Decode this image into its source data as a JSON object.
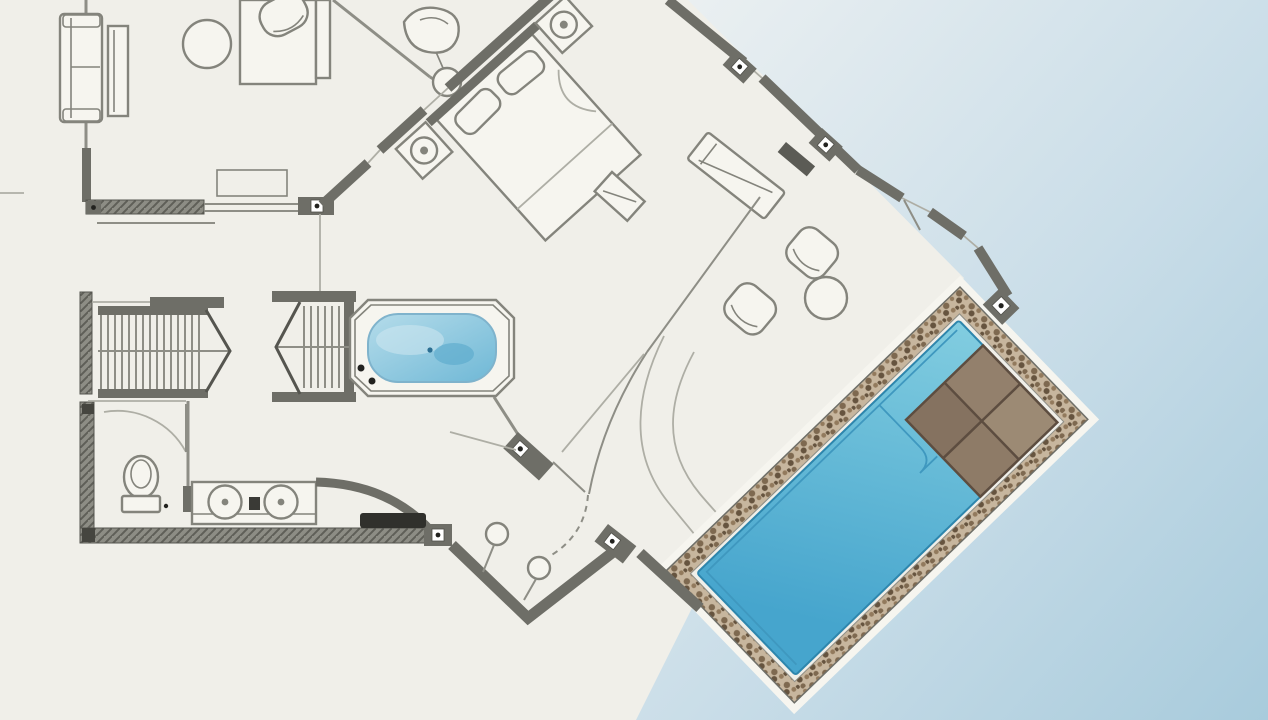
{
  "canvas": {
    "width": 1268,
    "height": 720,
    "viewBox": "0 0 1268 720"
  },
  "colors": {
    "paper": "#f0efe9",
    "paper_bright": "#f6f5ef",
    "wall": "#6e6e67",
    "wall_dark": "#45453f",
    "line": "#8e8e86",
    "line_light": "#aeaea5",
    "furn_line": "#84847c",
    "black": "#22221f",
    "lagoon_top": "#edf1f2",
    "lagoon_mid": "#c9dde8",
    "lagoon_deep": "#a8cbdc",
    "pool_light": "#82cde0",
    "pool_deep": "#46a5cd",
    "pool_edge": "#2e86ad",
    "pool_line": "#3f98bf",
    "tub_light": "#b5dcea",
    "tub_deep": "#6fb8d6",
    "deck_a": "#93806c",
    "deck_b": "#9c8a74",
    "deck_c": "#857260",
    "deck_d": "#8e7b67",
    "deck_line": "#5d4d40",
    "stone_bg": "#c7b69e",
    "pebble_1": "#7e6950",
    "pebble_2": "#927a5d",
    "pebble_3": "#66543f",
    "hatch_bg": "#8d8d85",
    "hatch_line": "#5f5f58",
    "mat": "#30302c"
  }
}
